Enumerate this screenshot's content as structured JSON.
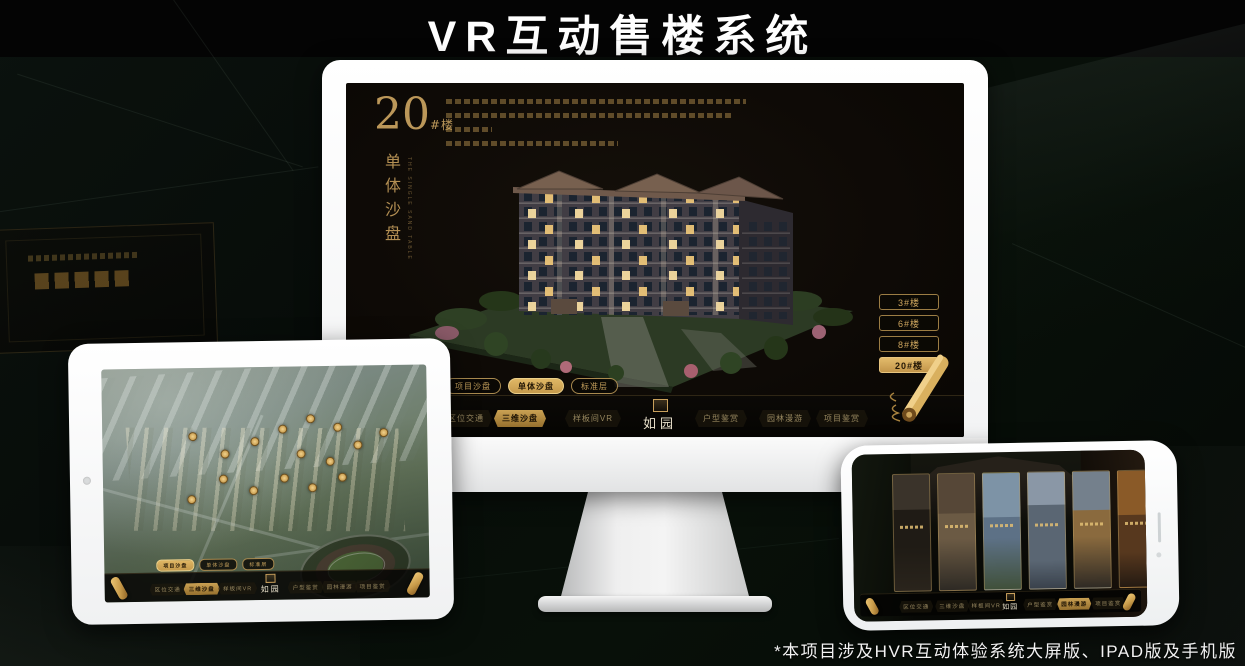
{
  "page": {
    "title": "VR互动售楼系统",
    "footnote": "*本项目涉及HVR互动体验系统大屏版、IPAD版及手机版"
  },
  "colors": {
    "gold": "#c9a05c",
    "gold_active": "#d8ab57",
    "screen_bg": "#0e0a06",
    "canvas_bg": "#070c09"
  },
  "monitor": {
    "panel": {
      "number": "20",
      "suffix": "#楼",
      "vertical_title": "单体沙盘",
      "subtitle_en": "THE SINGLE SAND TABLE"
    },
    "floor_buttons": [
      {
        "label": "3#楼",
        "active": false
      },
      {
        "label": "6#楼",
        "active": false
      },
      {
        "label": "8#楼",
        "active": false
      },
      {
        "label": "20#楼",
        "active": true
      }
    ],
    "sub_tabs": [
      {
        "label": "项目沙盘",
        "active": false
      },
      {
        "label": "单体沙盘",
        "active": true
      },
      {
        "label": "标准层",
        "active": false
      }
    ],
    "nav": {
      "logo": "如园",
      "items": [
        {
          "label": "区位交通",
          "active": false
        },
        {
          "label": "三维沙盘",
          "active": true
        },
        {
          "label": "样板间VR",
          "active": false
        },
        {
          "label": "户型鉴赏",
          "active": false
        },
        {
          "label": "园林漫游",
          "active": false
        },
        {
          "label": "项目鉴赏",
          "active": false
        }
      ]
    }
  },
  "tablet": {
    "sub_tabs": [
      {
        "label": "项目沙盘",
        "active": true
      },
      {
        "label": "单体沙盘",
        "active": false
      },
      {
        "label": "标准层",
        "active": false
      }
    ],
    "nav": {
      "logo": "如园",
      "items": [
        {
          "label": "区位交通",
          "active": false
        },
        {
          "label": "三维沙盘",
          "active": true
        },
        {
          "label": "样板间VR",
          "active": false
        },
        {
          "label": "户型鉴赏",
          "active": false
        },
        {
          "label": "园林漫游",
          "active": false
        },
        {
          "label": "项目鉴赏",
          "active": false
        }
      ]
    }
  },
  "phone": {
    "nav": {
      "logo": "如园",
      "items": [
        {
          "label": "区位交通",
          "active": false
        },
        {
          "label": "三维沙盘",
          "active": false
        },
        {
          "label": "样板间VR",
          "active": false
        },
        {
          "label": "户型鉴赏",
          "active": false
        },
        {
          "label": "园林漫游",
          "active": true
        },
        {
          "label": "项目鉴赏",
          "active": false
        }
      ]
    }
  }
}
